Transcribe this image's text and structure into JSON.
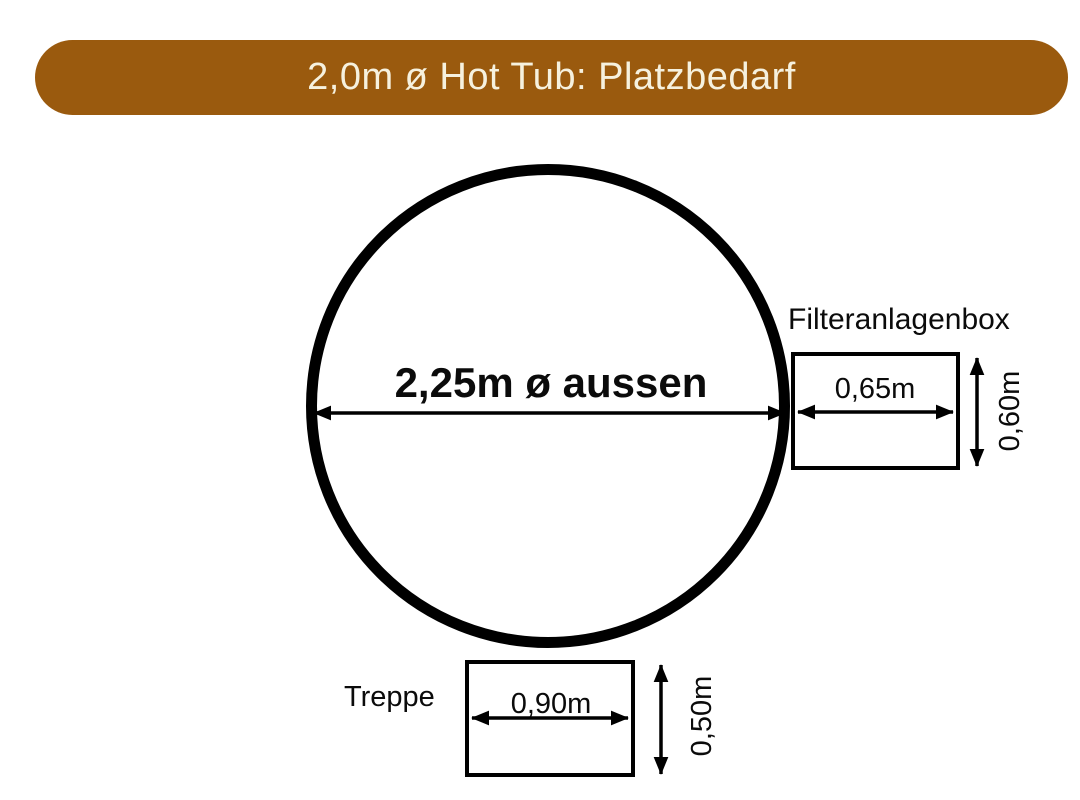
{
  "colors": {
    "background": "#FFFFFF",
    "banner_bg": "#9A5A0E",
    "banner_text": "#F6F1DE",
    "line": "#000000"
  },
  "banner": {
    "title": "2,0m ø Hot Tub: Platzbedarf"
  },
  "diagram": {
    "tub": {
      "diameter_label": "2,25m ø aussen"
    },
    "filter_box": {
      "label": "Filteranlagenbox",
      "width_label": "0,65m",
      "height_label": "0,60m"
    },
    "stairs": {
      "label": "Treppe",
      "width_label": "0,90m",
      "height_label": "0,50m"
    }
  }
}
